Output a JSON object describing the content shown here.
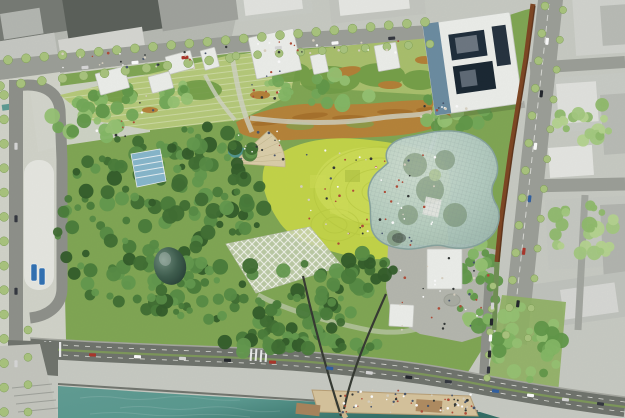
{
  "meta": {
    "description": "Aerial masterplan rendering of a riverside park surrounded by city blocks"
  },
  "colors": {
    "base": "#c8cbc3",
    "road": "#9b9e97",
    "asphalt": "#6e726b",
    "curb": "#a5a79f",
    "pave": "#d2d4ca",
    "pave_bright": "#e7e8e2",
    "plaza": "#b5b7ae",
    "park": "#7fa651",
    "slope": "#b6ca78",
    "lawn": "#c3d545",
    "lawn_hi": "#d6e35c",
    "meadow": "#b97f35",
    "meadow_dark": "#9c641f",
    "mound": "#6f9c43",
    "canopy": "#b7cfc8",
    "canopy_edge": "#86a39d",
    "canopy_grid": "#7e948f",
    "wall_rust": "#7c431f",
    "navy": "#1b2a38",
    "steel": "#5b7f99",
    "building_white": "#eef0ec",
    "glasshouse": "#86b7cc",
    "dome_dark": "#223c31",
    "dome_light": "#6f8d7d",
    "pond": "#4f948c",
    "river": "#58998f",
    "river_deep": "#2f6b63",
    "beach": "#d7c49c",
    "deck": "#a8835a",
    "median": "#7fa055",
    "street_tree": "#a9c47c",
    "bus": "#2d6fb3",
    "bridge": "#33372f"
  },
  "scene": {
    "seed": 1337,
    "tree_palettes": {
      "dark": [
        "#2f5a26",
        "#3c6b2e",
        "#477a37",
        "#548a41",
        "#61984b"
      ],
      "mid": [
        "#5f9747",
        "#71a855",
        "#83b763",
        "#95c271"
      ],
      "light": [
        "#8fbb6a",
        "#a3c97e",
        "#b5d48e"
      ]
    },
    "city_blocks": [
      {
        "x": -8,
        "y": -10,
        "w": 70,
        "h": 52,
        "rot": -9,
        "f": "#757973"
      },
      {
        "x": 60,
        "y": -14,
        "w": 95,
        "h": 58,
        "rot": -9,
        "f": "#595e58"
      },
      {
        "x": 155,
        "y": -18,
        "w": 80,
        "h": 50,
        "rot": -9,
        "f": "#9fa29c"
      },
      {
        "x": -5,
        "y": 42,
        "w": 60,
        "h": 28,
        "rot": -9,
        "f": "#c7c9c3"
      },
      {
        "x": 58,
        "y": 40,
        "w": 85,
        "h": 26,
        "rot": -9,
        "f": "#d6d7d2"
      },
      {
        "x": 0,
        "y": 14,
        "w": 40,
        "h": 26,
        "rot": -9,
        "f": "#b4b7b1"
      },
      {
        "x": 235,
        "y": -8,
        "w": 75,
        "h": 30,
        "rot": -7,
        "f": "#c9ccc5"
      },
      {
        "x": 243,
        "y": -4,
        "w": 58,
        "h": 20,
        "rot": -7,
        "f": "#e4e5e1"
      },
      {
        "x": 328,
        "y": -10,
        "w": 95,
        "h": 34,
        "rot": -6,
        "f": "#c4c7c0"
      },
      {
        "x": 338,
        "y": -6,
        "w": 70,
        "h": 22,
        "rot": -6,
        "f": "#e8e9e5"
      },
      {
        "x": 572,
        "y": -4,
        "w": 60,
        "h": 60,
        "rot": -4,
        "f": "#d2d4cf"
      },
      {
        "x": 600,
        "y": 6,
        "w": 28,
        "h": 40,
        "rot": -4,
        "f": "#b9bcb6"
      },
      {
        "x": 548,
        "y": 78,
        "w": 80,
        "h": 55,
        "rot": -4,
        "f": "#c9ccc6"
      },
      {
        "x": 556,
        "y": 84,
        "w": 40,
        "h": 40,
        "rot": -4,
        "f": "#e2e3df"
      },
      {
        "x": 600,
        "y": 95,
        "w": 28,
        "h": 60,
        "rot": -4,
        "f": "#b9bcb6"
      },
      {
        "x": 545,
        "y": 200,
        "w": 85,
        "h": 70,
        "rot": -3,
        "f": "#c6c9c2"
      },
      {
        "x": 600,
        "y": 205,
        "w": 28,
        "h": 70,
        "rot": -3,
        "f": "#b2b5af"
      },
      {
        "x": 528,
        "y": 285,
        "w": 100,
        "h": 45,
        "rot": -8,
        "f": "#c0c3bd"
      },
      {
        "x": 560,
        "y": 290,
        "w": 55,
        "h": 30,
        "rot": -8,
        "f": "#d8d9d5"
      },
      {
        "x": 548,
        "y": 148,
        "w": 44,
        "h": 30,
        "rot": -4,
        "f": "#e6e7e3"
      }
    ],
    "pavilions": [
      {
        "x": 95,
        "y": 74,
        "w": 30,
        "h": 22,
        "rot": -15
      },
      {
        "x": 148,
        "y": 77,
        "w": 22,
        "h": 17,
        "rot": -15
      },
      {
        "x": 165,
        "y": 57,
        "w": 26,
        "h": 18,
        "rot": -15
      },
      {
        "x": 200,
        "y": 51,
        "w": 15,
        "h": 20,
        "rot": -15
      },
      {
        "x": 248,
        "y": 38,
        "w": 46,
        "h": 42,
        "rot": -12
      },
      {
        "x": 310,
        "y": 56,
        "w": 15,
        "h": 19,
        "rot": -12
      },
      {
        "x": 374,
        "y": 46,
        "w": 22,
        "h": 26,
        "rot": -10
      },
      {
        "x": 390,
        "y": 304,
        "w": 24,
        "h": 22,
        "rot": 3
      },
      {
        "x": 427,
        "y": 249,
        "w": 35,
        "h": 40,
        "rot": 0
      }
    ],
    "forest_clusters": [
      {
        "cx": 135,
        "cy": 225,
        "rx": 80,
        "ry": 90,
        "count": 110,
        "pal": "dark"
      },
      {
        "cx": 262,
        "cy": 300,
        "rx": 110,
        "ry": 42,
        "count": 85,
        "pal": "dark"
      },
      {
        "cx": 205,
        "cy": 152,
        "rx": 48,
        "ry": 26,
        "count": 35,
        "pal": "dark"
      },
      {
        "cx": 240,
        "cy": 205,
        "rx": 28,
        "ry": 30,
        "count": 26,
        "pal": "dark"
      },
      {
        "cx": 300,
        "cy": 345,
        "rx": 80,
        "ry": 10,
        "count": 24,
        "pal": "dark"
      },
      {
        "cx": 365,
        "cy": 270,
        "rx": 30,
        "ry": 18,
        "count": 18,
        "pal": "dark"
      },
      {
        "cx": 92,
        "cy": 112,
        "rx": 50,
        "ry": 26,
        "count": 24,
        "pal": "mid"
      },
      {
        "cx": 455,
        "cy": 108,
        "rx": 42,
        "ry": 20,
        "count": 24,
        "pal": "mid"
      },
      {
        "cx": 478,
        "cy": 285,
        "rx": 22,
        "ry": 42,
        "count": 30,
        "pal": "mid"
      },
      {
        "cx": 528,
        "cy": 345,
        "rx": 34,
        "ry": 40,
        "count": 34,
        "pal": "mid"
      },
      {
        "cx": 320,
        "cy": 90,
        "rx": 60,
        "ry": 18,
        "count": 22,
        "pal": "mid"
      },
      {
        "cx": 160,
        "cy": 95,
        "rx": 40,
        "ry": 14,
        "count": 14,
        "pal": "mid"
      },
      {
        "cx": 582,
        "cy": 232,
        "rx": 38,
        "ry": 28,
        "count": 26,
        "pal": "light"
      },
      {
        "cx": 585,
        "cy": 120,
        "rx": 30,
        "ry": 22,
        "count": 20,
        "pal": "light"
      }
    ],
    "street_tree_rows": [
      {
        "x1": 8,
        "y1": 60,
        "x2": 425,
        "y2": 22,
        "count": 24,
        "r": 4.5
      },
      {
        "x1": 0,
        "y1": 86,
        "x2": 230,
        "y2": 58,
        "count": 12,
        "r": 4.5
      },
      {
        "x1": 236,
        "y1": 56,
        "x2": 430,
        "y2": 44,
        "count": 10,
        "r": 4
      },
      {
        "x1": 545,
        "y1": 6,
        "x2": 506,
        "y2": 335,
        "count": 13,
        "r": 4
      },
      {
        "x1": 563,
        "y1": 10,
        "x2": 528,
        "y2": 338,
        "count": 12,
        "r": 3.6
      },
      {
        "x1": 4,
        "y1": 95,
        "x2": 4,
        "y2": 412,
        "count": 14,
        "r": 4.5
      },
      {
        "x1": 28,
        "y1": 330,
        "x2": 28,
        "y2": 412,
        "count": 4,
        "r": 4
      },
      {
        "x1": 493,
        "y1": 286,
        "x2": 487,
        "y2": 378,
        "count": 5,
        "r": 3.4
      }
    ],
    "car_colors": [
      "#ffffff",
      "#30343c",
      "#2d5d9f",
      "#aa3327",
      "#d8d8d8",
      "#1f2328"
    ],
    "car_rows": [
      {
        "x1": 60,
        "y1": 70,
        "x2": 210,
        "y2": 55,
        "count": 3
      },
      {
        "x1": 250,
        "y1": 50,
        "x2": 420,
        "y2": 36,
        "count": 3
      },
      {
        "x1": 550,
        "y1": 15,
        "x2": 515,
        "y2": 330,
        "count": 6
      },
      {
        "x1": 16,
        "y1": 110,
        "x2": 16,
        "y2": 400,
        "count": 4
      },
      {
        "x1": 70,
        "y1": 354,
        "x2": 295,
        "y2": 363,
        "count": 5
      },
      {
        "x1": 310,
        "y1": 366,
        "x2": 468,
        "y2": 384,
        "count": 4
      },
      {
        "x1": 478,
        "y1": 389,
        "x2": 618,
        "y2": 406,
        "count": 4
      },
      {
        "x1": 493,
        "y1": 298,
        "x2": 488,
        "y2": 378,
        "count": 5
      }
    ],
    "buses": [
      {
        "x": 31,
        "y": 264,
        "w": 6,
        "h": 17
      },
      {
        "x": 39,
        "y": 268,
        "w": 6,
        "h": 17
      }
    ],
    "crowd_palette": [
      "#2f3433",
      "#ffffff",
      "#b04a35",
      "#46536b",
      "#d9d2c2"
    ],
    "crowd_areas": [
      {
        "x": 300,
        "y": 150,
        "w": 135,
        "h": 95,
        "count": 60
      },
      {
        "x": 338,
        "y": 390,
        "w": 135,
        "h": 24,
        "count": 55
      },
      {
        "x": 398,
        "y": 255,
        "w": 95,
        "h": 75,
        "count": 32
      },
      {
        "x": 62,
        "y": 52,
        "w": 150,
        "h": 16,
        "count": 22
      },
      {
        "x": 220,
        "y": 40,
        "w": 180,
        "h": 14,
        "count": 22
      },
      {
        "x": 238,
        "y": 130,
        "w": 46,
        "h": 30,
        "count": 15
      },
      {
        "x": 250,
        "y": 60,
        "w": 30,
        "h": 55,
        "count": 12
      },
      {
        "x": 95,
        "y": 95,
        "w": 60,
        "h": 50,
        "count": 10
      },
      {
        "x": 420,
        "y": 100,
        "w": 60,
        "h": 18,
        "count": 10
      },
      {
        "x": 440,
        "y": 398,
        "w": 40,
        "h": 14,
        "count": 12
      }
    ]
  }
}
